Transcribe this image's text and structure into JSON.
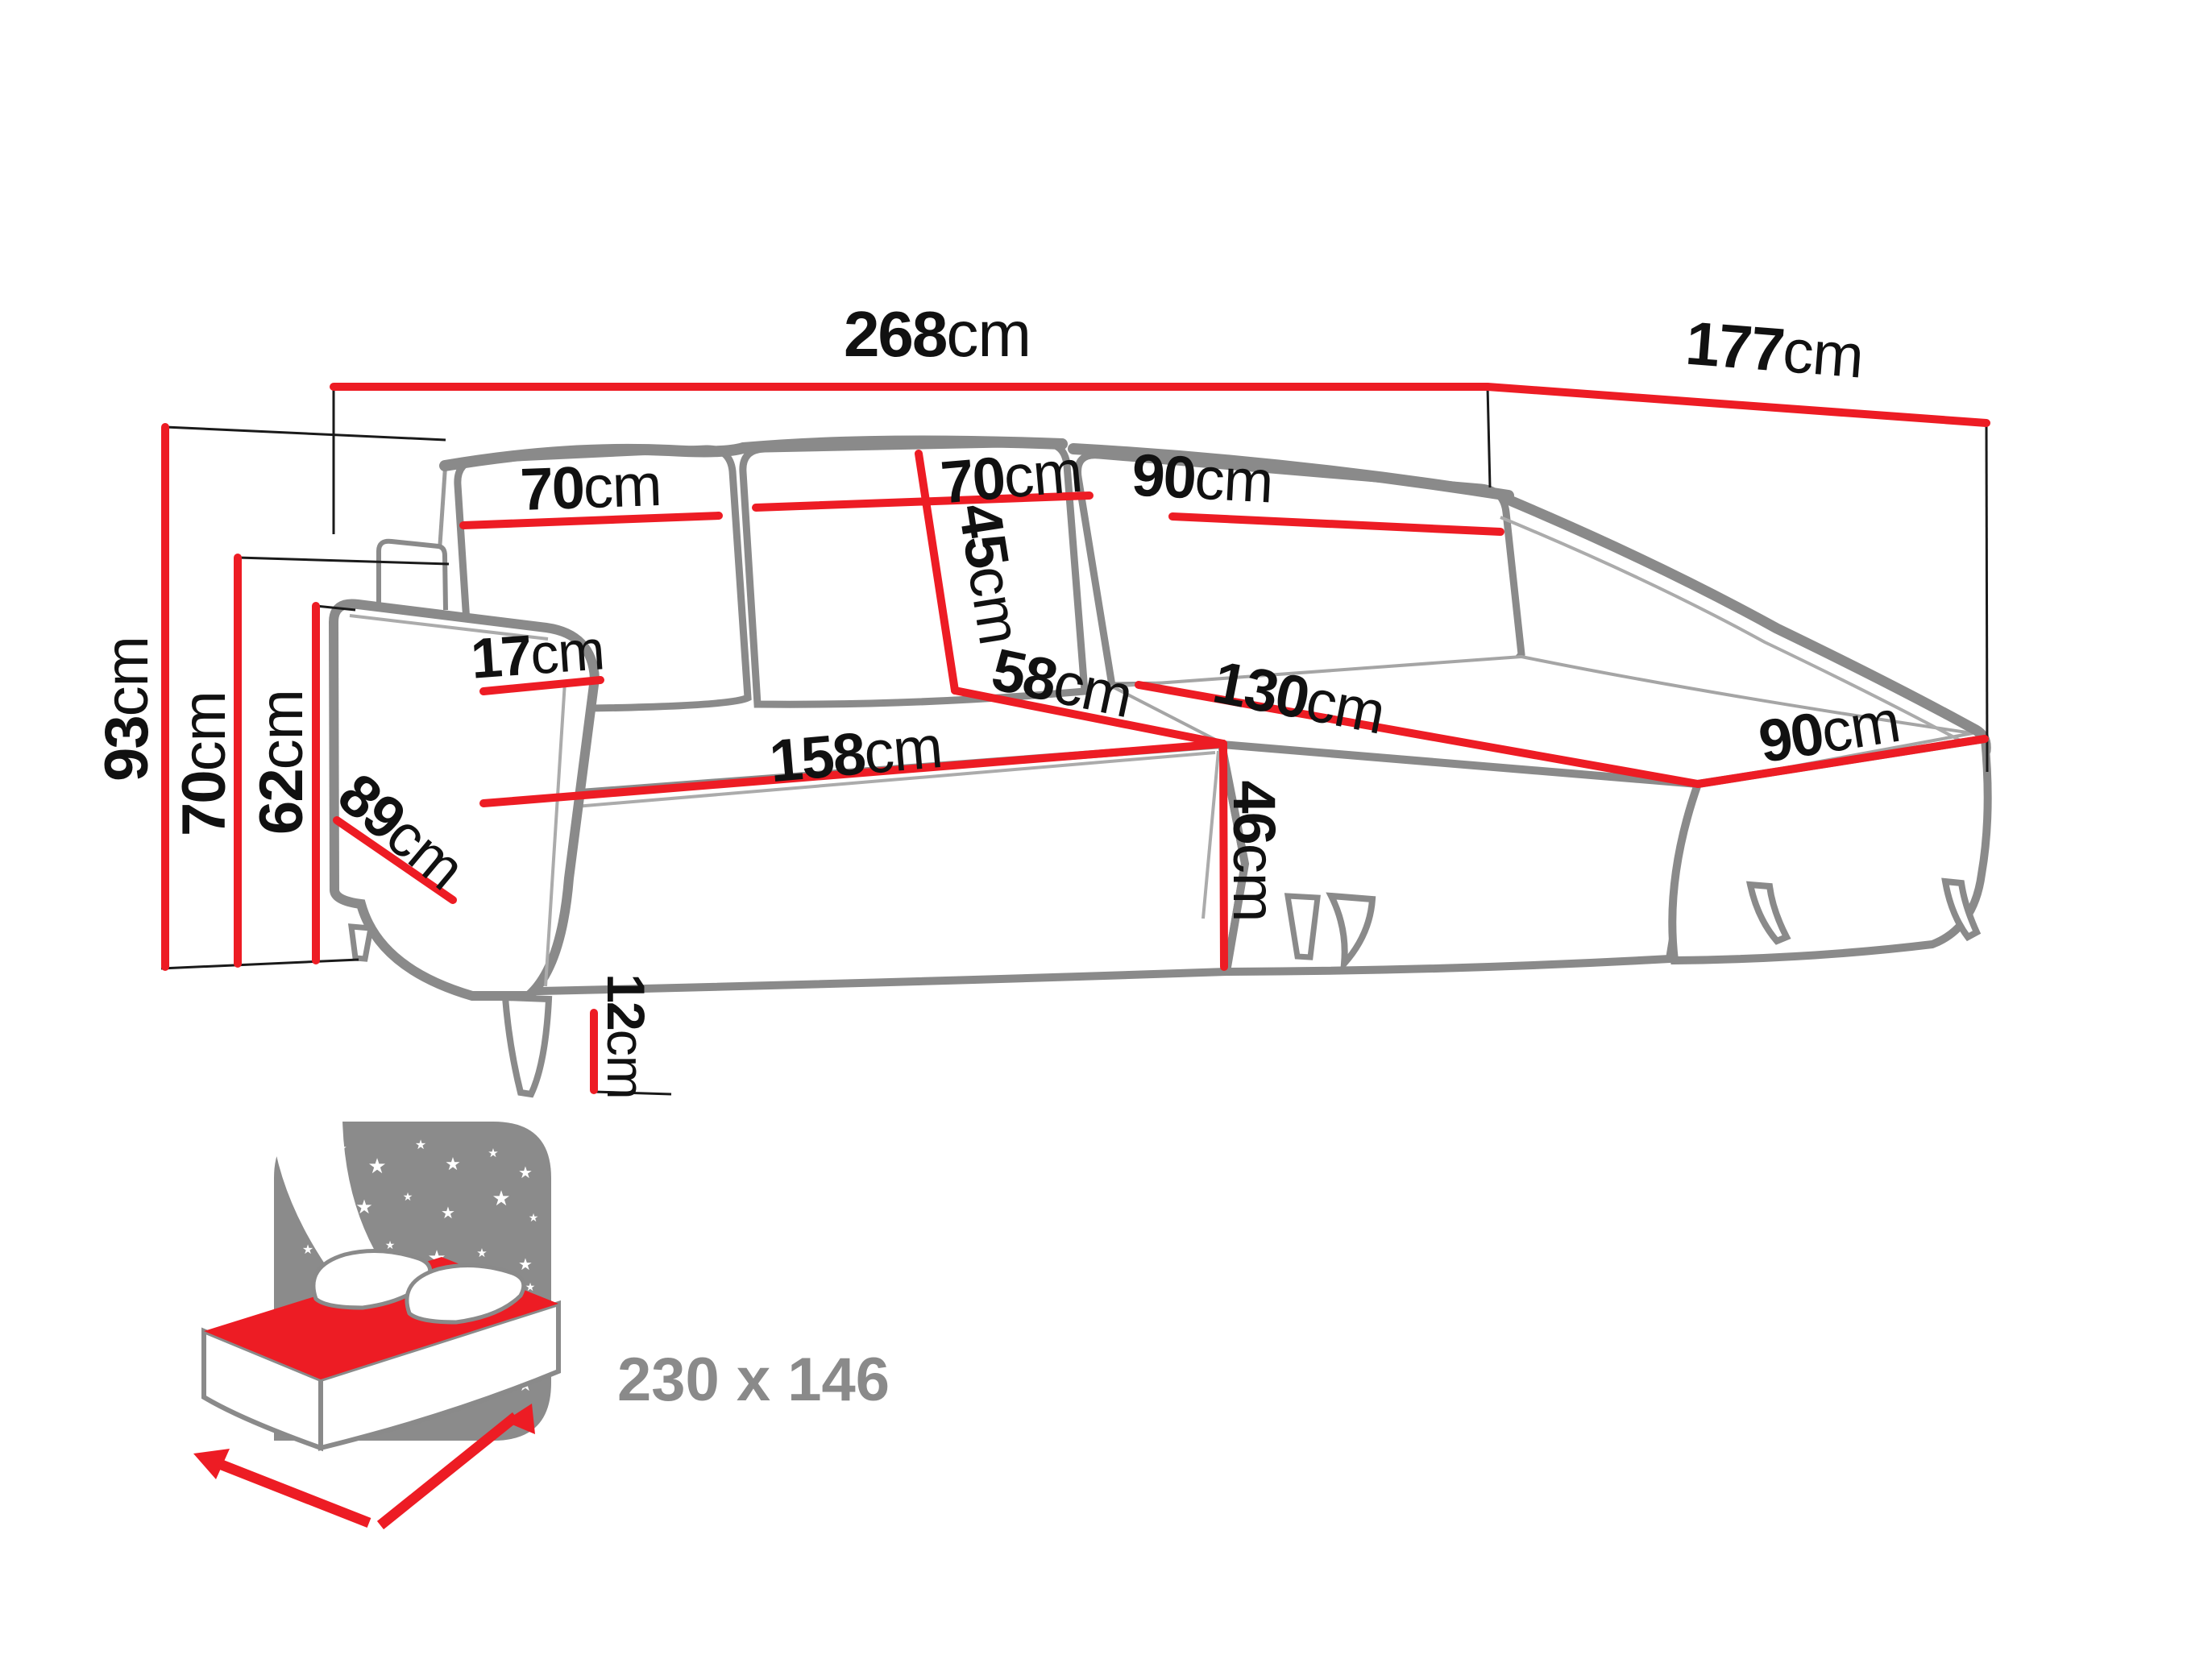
{
  "diagram": {
    "type": "corner-sofa-dimension-diagram",
    "colors": {
      "dimension_line": "#ed1c24",
      "sofa_outline": "#8a8a8a",
      "label_text": "#111111",
      "muted_text": "#8a8a8a",
      "background": "#ffffff"
    },
    "dims": {
      "total_width": {
        "value": "268",
        "unit": "cm"
      },
      "total_depth": {
        "value": "177",
        "unit": "cm"
      },
      "total_height": {
        "value": "93",
        "unit": "cm"
      },
      "backrest_height": {
        "value": "70",
        "unit": "cm"
      },
      "armrest_height": {
        "value": "62",
        "unit": "cm"
      },
      "back_cushion_left_width": {
        "value": "70",
        "unit": "cm"
      },
      "back_cushion_middle_width": {
        "value": "70",
        "unit": "cm"
      },
      "back_cushion_corner_width": {
        "value": "90",
        "unit": "cm"
      },
      "back_cushion_height": {
        "value": "45",
        "unit": "cm"
      },
      "armrest_width": {
        "value": "17",
        "unit": "cm"
      },
      "seat_depth": {
        "value": "58",
        "unit": "cm"
      },
      "seat_front_width": {
        "value": "158",
        "unit": "cm"
      },
      "armrest_depth": {
        "value": "89",
        "unit": "cm"
      },
      "chaise_length": {
        "value": "130",
        "unit": "cm"
      },
      "chaise_width": {
        "value": "90",
        "unit": "cm"
      },
      "seat_height": {
        "value": "46",
        "unit": "cm"
      },
      "leg_height": {
        "value": "12",
        "unit": "cm"
      }
    },
    "sleeping_area": {
      "icon": "bed-night-icon",
      "dimensions_label": "230 x 146"
    }
  }
}
